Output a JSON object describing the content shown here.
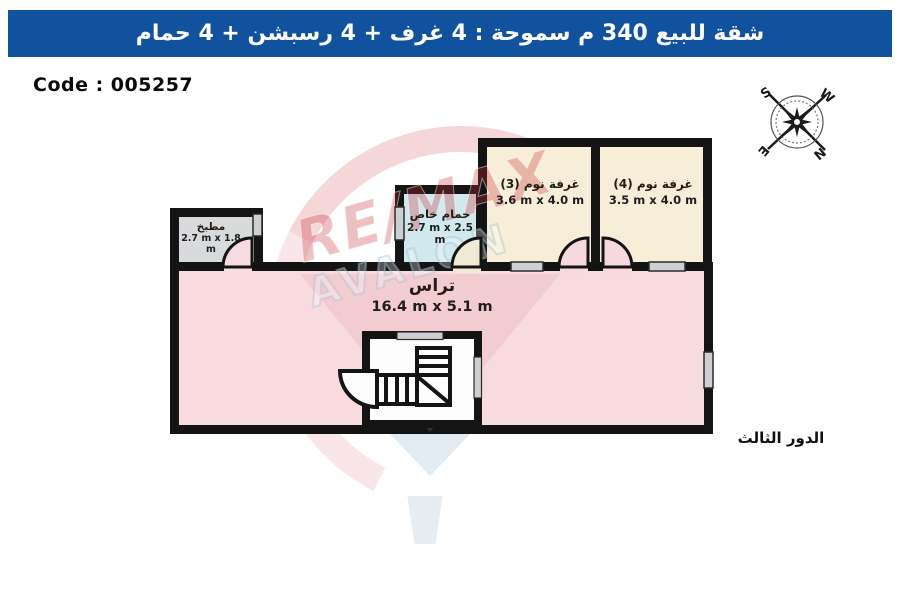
{
  "header": {
    "title": "شقة للبيع 340 م سموحة  :  4 غرف + 4 رسبشن + 4 حمام",
    "bg_color": "#11529e"
  },
  "code_label": "Code : 005257",
  "floor_label": "الدور الثالث",
  "compass": {
    "s": "S",
    "w": "W",
    "e": "E",
    "n": "N"
  },
  "watermark": {
    "brand": "RE/MAX",
    "office": "AVALON",
    "red": "#cd3741",
    "blue": "#a5c3d7"
  },
  "rooms": {
    "kitchen": {
      "name": "مطبخ",
      "dims": "2.7 m x 1.8 m",
      "color": "#d9dadb"
    },
    "bathroom": {
      "name": "حمام خاص",
      "dims": "2.7 m x 2.5 m",
      "color": "#cfe9ec"
    },
    "bedroom3": {
      "name": "غرفة نوم (3)",
      "dims": "3.6 m x 4.0 m",
      "color": "#f6eed6"
    },
    "bedroom4": {
      "name": "غرفة نوم (4)",
      "dims": "3.5 m x 4.0 m",
      "color": "#f6eed6"
    },
    "terrace": {
      "name": "تراس",
      "dims": "16.4 m x 5.1 m",
      "color": "#f8dbdf"
    }
  },
  "colors": {
    "wall": "#141414",
    "window": "#cdd0d2",
    "stair_box": "#fcfcfc"
  }
}
